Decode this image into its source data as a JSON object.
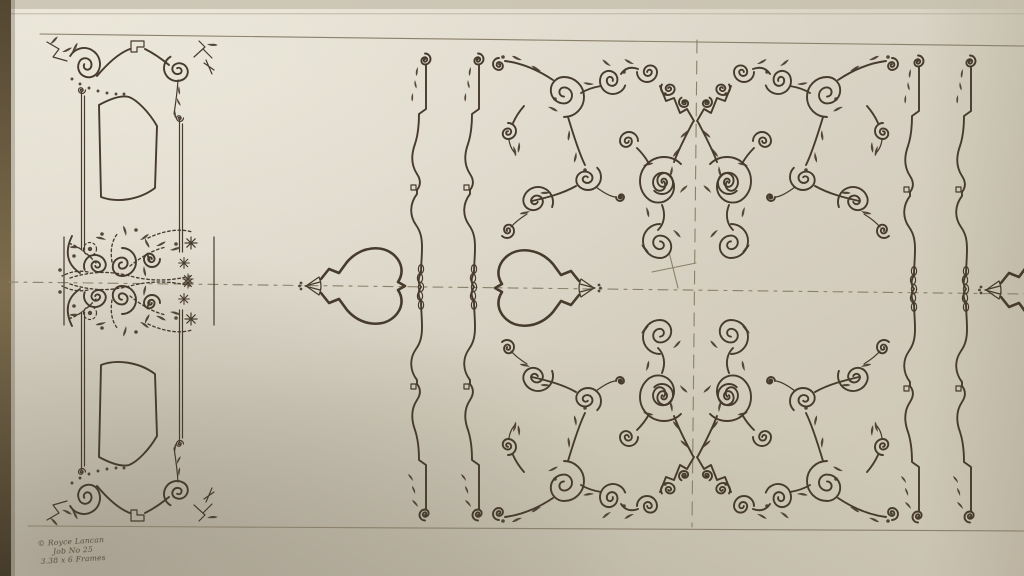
{
  "meta": {
    "alt": "Photograph of a hand-inked symmetrical ornamental scrollwork pattern drawn on cream paper"
  },
  "annotation": {
    "line1": "© Royce Lancan",
    "line2": "Job No 25",
    "line3": "3.38 x 6 Frames"
  },
  "colors": {
    "ink": "#46392a",
    "pencil": "#8b8069",
    "paper-light": "#e7e2d4",
    "paper-mid": "#dcd6c6",
    "paper-dark": "#c9c1ad",
    "table-edge": "#5d4e35"
  },
  "motifs": {
    "cartouche": "Ornate panel cartouche with floral bouquet",
    "spade": "Spade finial on horizontal centerline",
    "molding": "Baluster molding profile with chain links",
    "quadrant": "Acanthus scroll quadrant, mirrored four ways",
    "crosshair": "Pencil registration crosshair and dashed centerlines"
  }
}
